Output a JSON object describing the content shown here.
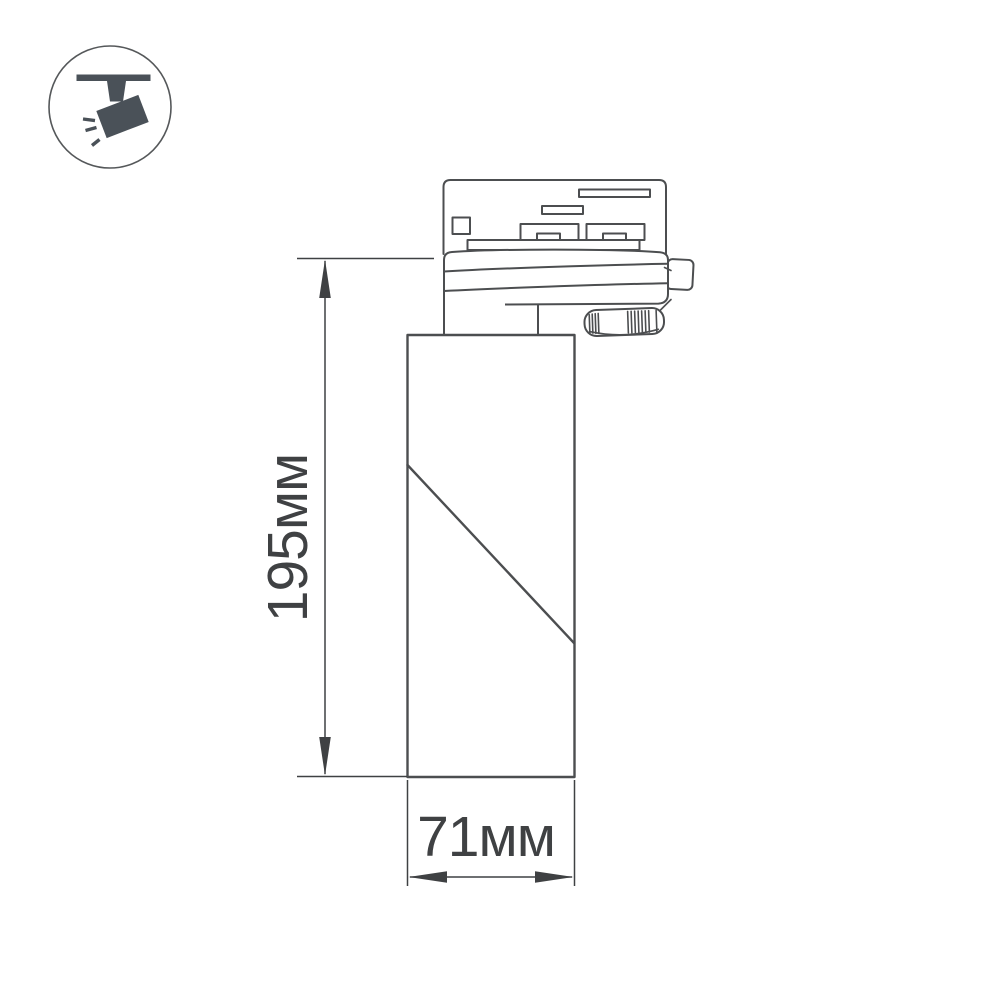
{
  "page": {
    "background_color": "#ffffff"
  },
  "badge": {
    "icon": "track-spotlight-icon",
    "icon_color": "#4a5158",
    "circle_color": "#55585a"
  },
  "drawing": {
    "line_color": "#4c4e50",
    "dimension_color": "#3f4143",
    "dimensions": {
      "height": {
        "value": "195",
        "unit": "мм",
        "label": "195мм"
      },
      "width": {
        "value": "71",
        "unit": "мм",
        "label": "71мм"
      }
    }
  }
}
